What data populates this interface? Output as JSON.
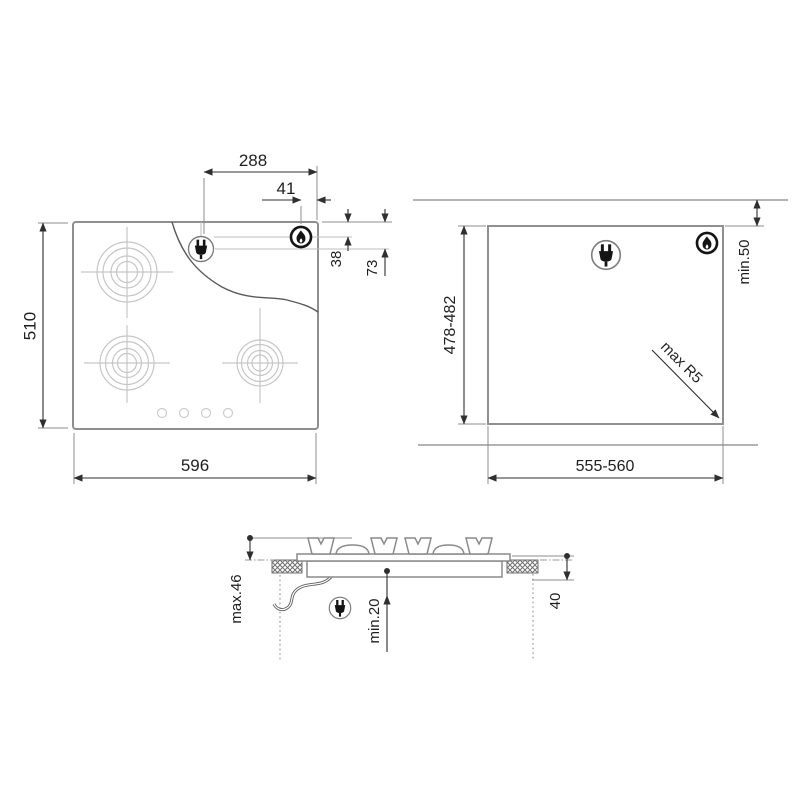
{
  "colors": {
    "background": "#ffffff",
    "dimension_line": "#2f2f2f",
    "text": "#1f1f1f",
    "outline_gray": "#8f8f8f",
    "burner_gray": "#c6c6c6",
    "wall_gray": "#a8a8a8",
    "icon_black": "#141414"
  },
  "icons": {
    "plug": "plug-icon",
    "flame": "flame-icon"
  },
  "top_view": {
    "dims": {
      "plug_from_right_edge": "288",
      "flame_from_right_edge": "41",
      "flame_from_top_edge": "38",
      "plug_from_top_edge": "73",
      "hob_depth": "510",
      "hob_width": "596"
    }
  },
  "cutout_view": {
    "dims": {
      "cutout_depth": "478-482",
      "cutout_width": "555-560",
      "rear_clearance": "min.50",
      "corner_radius": "max R5"
    }
  },
  "side_view": {
    "dims": {
      "overall_height": "max.46",
      "under_clearance": "min.20",
      "recess_depth": "40"
    }
  }
}
